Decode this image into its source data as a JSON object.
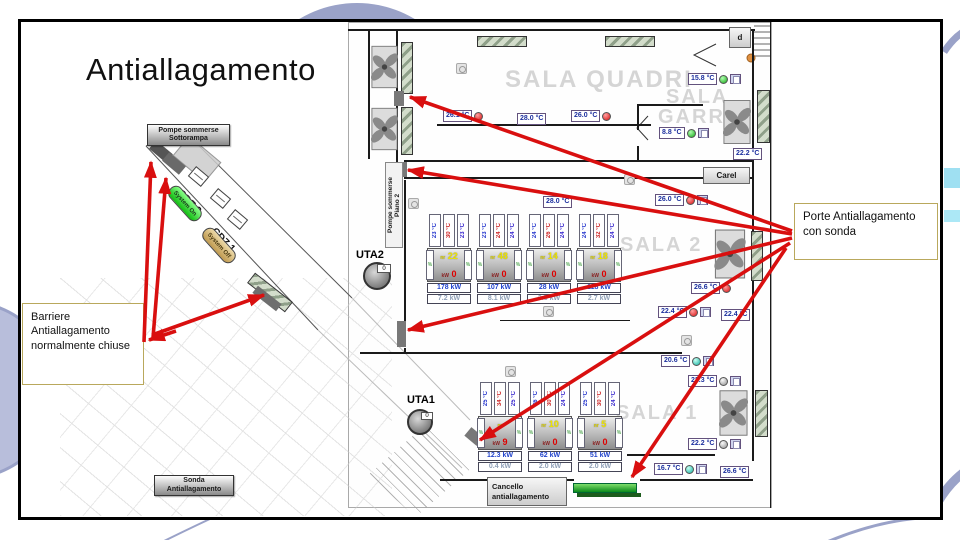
{
  "title": "Antiallagamento",
  "colors": {
    "arrow": "#d90f0f",
    "deco_arc": "#9aa2c8",
    "deco_circle_fill": "#b8bedb",
    "deco_cyan1": "#9fe0f2",
    "deco_cyan2": "#ace8f6",
    "callout_border": "#b9a85c",
    "watermark": "#d5d5d5"
  },
  "callouts": {
    "barriere": "Barriere\nAntiallagamento\nnormalmente chiuse",
    "porte": "Porte Antiallagamento\ncon sonda"
  },
  "map": {
    "watermarks": [
      {
        "text": "SALA QUADRI",
        "x": 505,
        "y": 66,
        "size": 24
      },
      {
        "text": "SALA",
        "x": 666,
        "y": 86,
        "size": 20
      },
      {
        "text": "GARR",
        "x": 658,
        "y": 106,
        "size": 20
      },
      {
        "text": "SALA 2",
        "x": 620,
        "y": 234,
        "size": 20
      },
      {
        "text": "SALA 1",
        "x": 616,
        "y": 402,
        "size": 20
      }
    ],
    "plates": [
      {
        "name": "pompe-sottorampa-plate",
        "text": "Pompe sommerse\nSottorampa",
        "x": 147,
        "y": 124,
        "w": 83,
        "h": 22,
        "style": "metal"
      },
      {
        "name": "sonda-antiallagamento-plate",
        "text": "Sonda\nAntiallagamento",
        "x": 154,
        "y": 475,
        "w": 80,
        "h": 21,
        "style": "metal"
      },
      {
        "name": "cancello-antiallagamento-plate",
        "text": "Cancello\nantiallagamento",
        "x": 487,
        "y": 477,
        "w": 80,
        "h": 29,
        "style": "panel left"
      },
      {
        "name": "carel-plate",
        "text": "Carel",
        "x": 703,
        "y": 167,
        "w": 47,
        "h": 17,
        "style": "panel"
      },
      {
        "name": "quadro-d-plate",
        "text": "d",
        "x": 729,
        "y": 27,
        "w": 22,
        "h": 21,
        "style": "panel"
      },
      {
        "name": "pompe-piano2-plate",
        "text": "Pompe sommerse\nPiano 2",
        "x": 385,
        "y": 162,
        "w": 18,
        "h": 86,
        "style": "vert"
      }
    ],
    "uta2": {
      "label": "UTA2",
      "value": "0"
    },
    "uta1": {
      "label": "UTA1",
      "value": "0"
    },
    "ramp": {
      "cdz2": "CDZ 2",
      "cdz1": "CDZ 1",
      "system_on": "System On",
      "system_off": "System Off"
    },
    "pct_symbol": "%",
    "kw_prefix": "kW",
    "set_prefix": "nr",
    "temps": [
      {
        "v": "26.1 °C",
        "dot": "red",
        "btn": false,
        "x": 443,
        "y": 110
      },
      {
        "v": "28.0 °C",
        "dot": null,
        "btn": false,
        "x": 517,
        "y": 113
      },
      {
        "v": "26.0 °C",
        "dot": "red",
        "btn": false,
        "x": 571,
        "y": 110
      },
      {
        "v": "15.8 °C",
        "dot": "green",
        "btn": true,
        "x": 688,
        "y": 73
      },
      {
        "v": "8.8 °C",
        "dot": "green",
        "btn": true,
        "x": 659,
        "y": 127
      },
      {
        "v": "22.2 °C",
        "dot": null,
        "btn": false,
        "x": 733,
        "y": 148
      },
      {
        "v": "26.0 °C",
        "dot": "red",
        "btn": true,
        "x": 655,
        "y": 194
      },
      {
        "v": "28.0 °C",
        "dot": null,
        "btn": false,
        "x": 543,
        "y": 196
      },
      {
        "v": "26.6 °C",
        "dot": "red",
        "btn": false,
        "x": 691,
        "y": 282
      },
      {
        "v": "22.4 °C",
        "dot": "red",
        "btn": true,
        "x": 658,
        "y": 306
      },
      {
        "v": "22.4 °C",
        "dot": null,
        "btn": false,
        "x": 721,
        "y": 309
      },
      {
        "v": "20.6 °C",
        "dot": "cyan",
        "btn": true,
        "x": 661,
        "y": 355
      },
      {
        "v": "22.3 °C",
        "dot": "gray",
        "btn": true,
        "x": 688,
        "y": 375
      },
      {
        "v": "22.2 °C",
        "dot": "gray",
        "btn": true,
        "x": 688,
        "y": 438
      },
      {
        "v": "16.7 °C",
        "dot": "cyan",
        "btn": true,
        "x": 654,
        "y": 463
      },
      {
        "v": "26.6 °C",
        "dot": null,
        "btn": false,
        "x": 720,
        "y": 466
      }
    ],
    "crac_sala2": [
      {
        "x": 427,
        "y": 214,
        "temps": [
          "23 °C",
          "30 °C",
          "23 °C"
        ],
        "set": "22",
        "kw0": "0",
        "p1": "178 kW",
        "p2": "7.2 kW"
      },
      {
        "x": 477,
        "y": 214,
        "temps": [
          "23 °C",
          "24 °C",
          "24 °C"
        ],
        "set": "48",
        "kw0": "0",
        "p1": "107 kW",
        "p2": "8.1 kW"
      },
      {
        "x": 527,
        "y": 214,
        "temps": [
          "24 °C",
          "26 °C",
          "24 °C"
        ],
        "set": "14",
        "kw0": "0",
        "p1": "28 kW",
        "p2": "3.5 kW"
      },
      {
        "x": 577,
        "y": 214,
        "temps": [
          "24 °C",
          "32 °C",
          "24 °C"
        ],
        "set": "18",
        "kw0": "0",
        "p1": "118 kW",
        "p2": "2.7 kW"
      }
    ],
    "crac_sala1": [
      {
        "x": 478,
        "y": 382,
        "temps": [
          "25 °C",
          "34 °C",
          "25 °C"
        ],
        "set": "",
        "kw0": "9",
        "p1": "12.3 kW",
        "p2": "0.4 kW"
      },
      {
        "x": 528,
        "y": 382,
        "temps": [
          "26 °C",
          "30 °C",
          "24 °C"
        ],
        "set": "10",
        "kw0": "0",
        "p1": "62 kW",
        "p2": "2.0 kW"
      },
      {
        "x": 578,
        "y": 382,
        "temps": [
          "25 °C",
          "30 °C",
          "24 °C"
        ],
        "set": "5",
        "kw0": "0",
        "p1": "51 kW",
        "p2": "2.0 kW"
      }
    ],
    "fans": [
      {
        "x": 371,
        "y": 44,
        "w": 27,
        "h": 46
      },
      {
        "x": 371,
        "y": 106,
        "w": 27,
        "h": 46
      },
      {
        "x": 723,
        "y": 99,
        "w": 28,
        "h": 46
      },
      {
        "x": 714,
        "y": 229,
        "w": 32,
        "h": 50
      },
      {
        "x": 719,
        "y": 388,
        "w": 29,
        "h": 50
      }
    ],
    "vents": [
      {
        "x": 477,
        "y": 36,
        "w": 50,
        "h": 11
      },
      {
        "x": 605,
        "y": 36,
        "w": 50,
        "h": 11
      },
      {
        "x": 401,
        "y": 42,
        "w": 12,
        "h": 52
      },
      {
        "x": 401,
        "y": 107,
        "w": 12,
        "h": 48
      },
      {
        "x": 757,
        "y": 90,
        "w": 13,
        "h": 53
      },
      {
        "x": 751,
        "y": 231,
        "w": 12,
        "h": 50
      },
      {
        "x": 755,
        "y": 390,
        "w": 13,
        "h": 47
      }
    ],
    "walls": [
      [
        348,
        29,
        50,
        2
      ],
      [
        395,
        29,
        360,
        2
      ],
      [
        396,
        29,
        2,
        64
      ],
      [
        396,
        106,
        2,
        56
      ],
      [
        368,
        31,
        2,
        128
      ],
      [
        437,
        124,
        214,
        2
      ],
      [
        404,
        160,
        350,
        2
      ],
      [
        404,
        177,
        350,
        2
      ],
      [
        637,
        104,
        66,
        2
      ],
      [
        637,
        104,
        2,
        26
      ],
      [
        637,
        146,
        2,
        16
      ],
      [
        404,
        180,
        2,
        142
      ],
      [
        404,
        348,
        2,
        6
      ],
      [
        360,
        352,
        322,
        2
      ],
      [
        500,
        320,
        130,
        1
      ],
      [
        627,
        454,
        88,
        2
      ],
      [
        440,
        479,
        134,
        2
      ],
      [
        640,
        479,
        113,
        2
      ],
      [
        752,
        29,
        2,
        432
      ],
      [
        770,
        22,
        1,
        486
      ]
    ],
    "doorblocks": [
      {
        "x": 394,
        "y": 91,
        "w": 10,
        "h": 15,
        "rot": 0
      },
      {
        "x": 397,
        "y": 162,
        "w": 10,
        "h": 15,
        "rot": 0
      },
      {
        "x": 397,
        "y": 321,
        "w": 9,
        "h": 26,
        "rot": 0
      },
      {
        "x": 466,
        "y": 431,
        "w": 16,
        "h": 11,
        "rot": 40
      }
    ],
    "devices": [
      {
        "x": 456,
        "y": 63
      },
      {
        "x": 408,
        "y": 198
      },
      {
        "x": 543,
        "y": 306
      },
      {
        "x": 505,
        "y": 366
      },
      {
        "x": 681,
        "y": 335
      },
      {
        "x": 624,
        "y": 174
      }
    ]
  },
  "arrows": [
    {
      "x1": 792,
      "y1": 231,
      "x2": 410,
      "y2": 97
    },
    {
      "x1": 792,
      "y1": 234,
      "x2": 408,
      "y2": 170
    },
    {
      "x1": 792,
      "y1": 238,
      "x2": 408,
      "y2": 330
    },
    {
      "x1": 790,
      "y1": 243,
      "x2": 480,
      "y2": 440
    },
    {
      "x1": 786,
      "y1": 248,
      "x2": 632,
      "y2": 477
    },
    {
      "x1": 144,
      "y1": 342,
      "x2": 151,
      "y2": 162
    },
    {
      "x1": 153,
      "y1": 338,
      "x2": 166,
      "y2": 178
    },
    {
      "x1": 152,
      "y1": 335,
      "x2": 264,
      "y2": 295
    },
    {
      "x1": 176,
      "y1": 331,
      "x2": 149,
      "y2": 340
    }
  ]
}
